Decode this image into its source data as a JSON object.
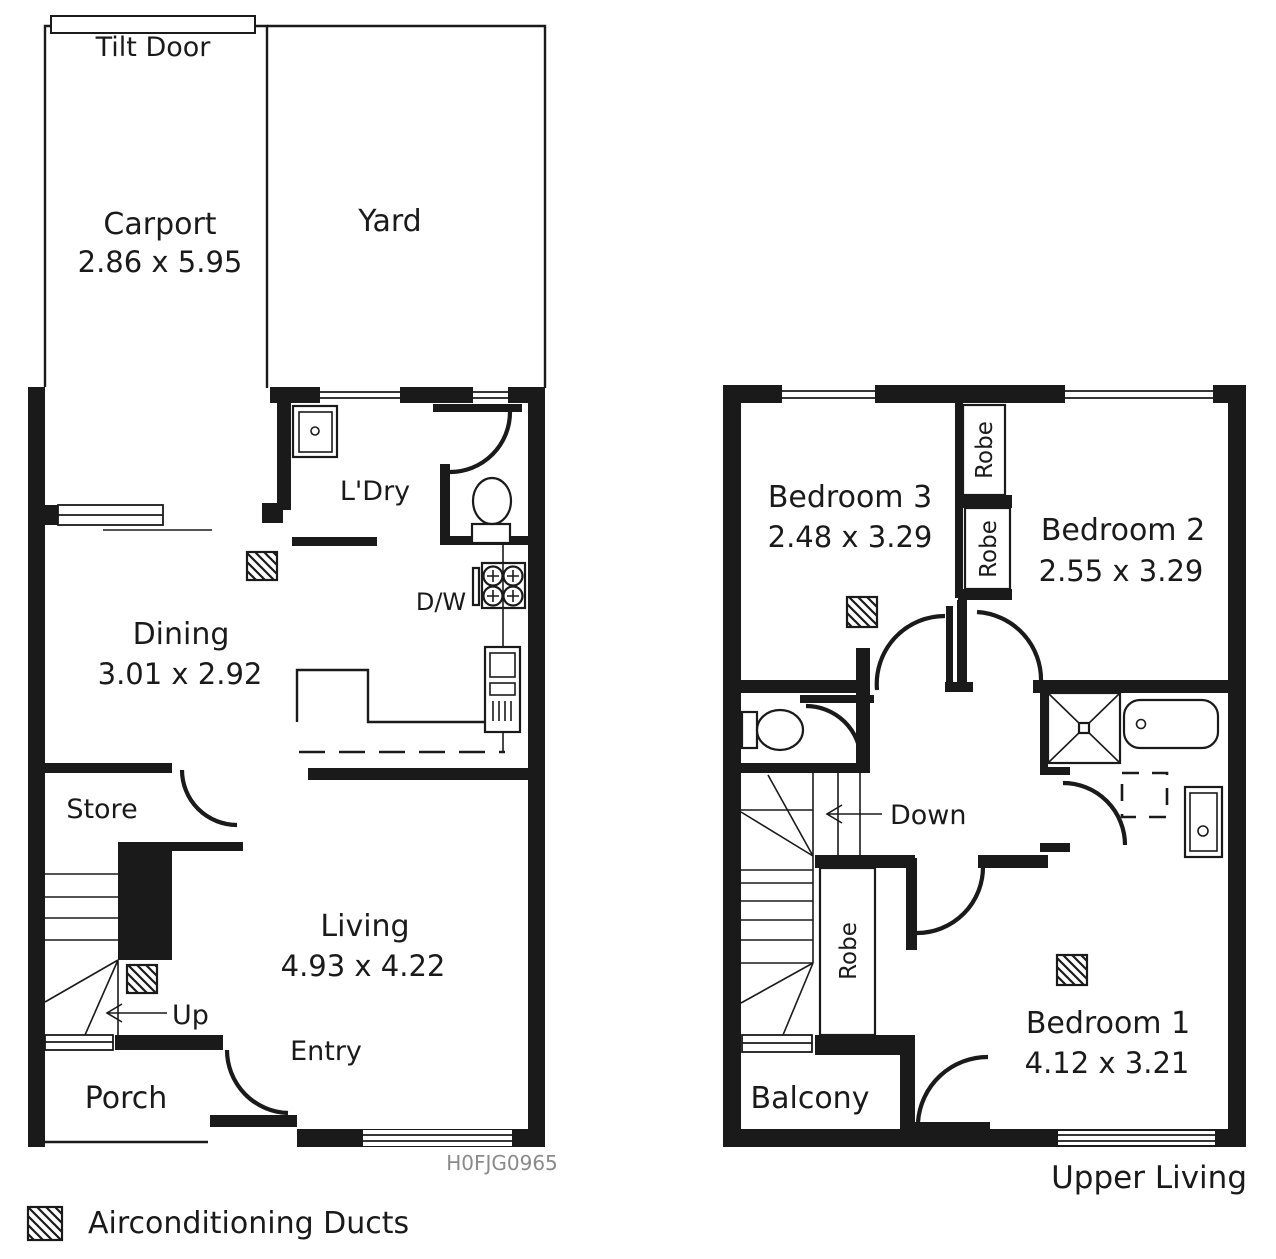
{
  "colors": {
    "ink": "#1a1a1a",
    "code_text": "#8a8a8a"
  },
  "ground_floor": {
    "tilt_door": "Tilt Door",
    "carport": {
      "name": "Carport",
      "dims": "2.86 x 5.95"
    },
    "yard": {
      "name": "Yard"
    },
    "laundry": {
      "name": "L'Dry"
    },
    "dishwasher": "D/W",
    "dining": {
      "name": "Dining",
      "dims": "3.01 x 2.92"
    },
    "store": {
      "name": "Store"
    },
    "living": {
      "name": "Living",
      "dims": "4.93 x 4.22"
    },
    "stairs_direction": "Up",
    "entry": "Entry",
    "porch": "Porch",
    "plan_code": "H0FJG0965"
  },
  "upper_floor": {
    "bedroom3": {
      "name": "Bedroom 3",
      "dims": "2.48 x 3.29"
    },
    "bedroom2": {
      "name": "Bedroom 2",
      "dims": "2.55 x 3.29"
    },
    "bedroom1": {
      "name": "Bedroom 1",
      "dims": "4.12 x 3.21"
    },
    "robe_bed3": "Robe",
    "robe_bed2": "Robe",
    "robe_bed1": "Robe",
    "stairs_direction": "Down",
    "balcony": {
      "name": "Balcony"
    },
    "caption": "Upper Living"
  },
  "legend": {
    "airconditioning_ducts": "Airconditioning Ducts"
  }
}
